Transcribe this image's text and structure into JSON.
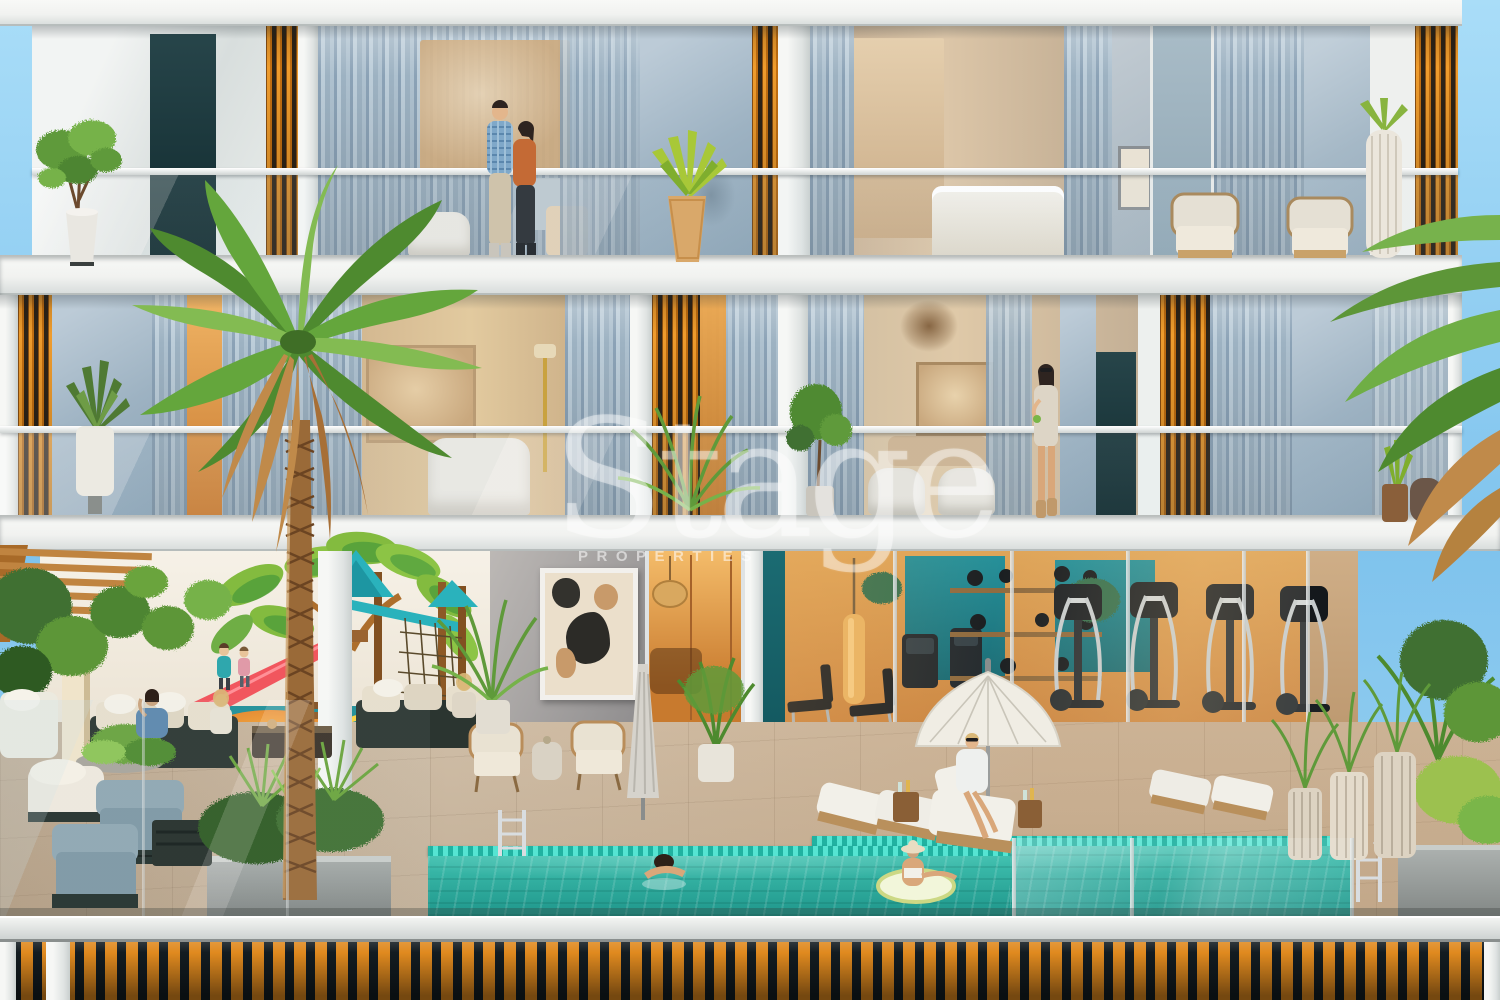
{
  "watermark": {
    "brand": "Stage",
    "subtitle": "PROPERTIES"
  },
  "palette": {
    "sky": "#8ccdf0",
    "facade_white": "#f2f3f1",
    "louver_orange": "#dd8a20",
    "curtain_blue": "#a7bccb",
    "wall_blue_gray": "#9db2c2",
    "interior_warm": "#d08a3e",
    "marble_tan": "#dcc3a0",
    "gym_teal": "#15808a",
    "pool_water": "#2aa99c",
    "pool_tile": "#3fd9c6",
    "deck_tan": "#c9b7a0",
    "fence_dark": "#131c21",
    "fence_slat": "#e08a1f",
    "mural_leaf_green": "#83bb3f",
    "slide_red": "#f1565e",
    "play_teal": "#2ab2bc",
    "palm_green": "#5d9638",
    "dried_frond": "#c08a4a",
    "wood_pergola": "#c08440"
  }
}
